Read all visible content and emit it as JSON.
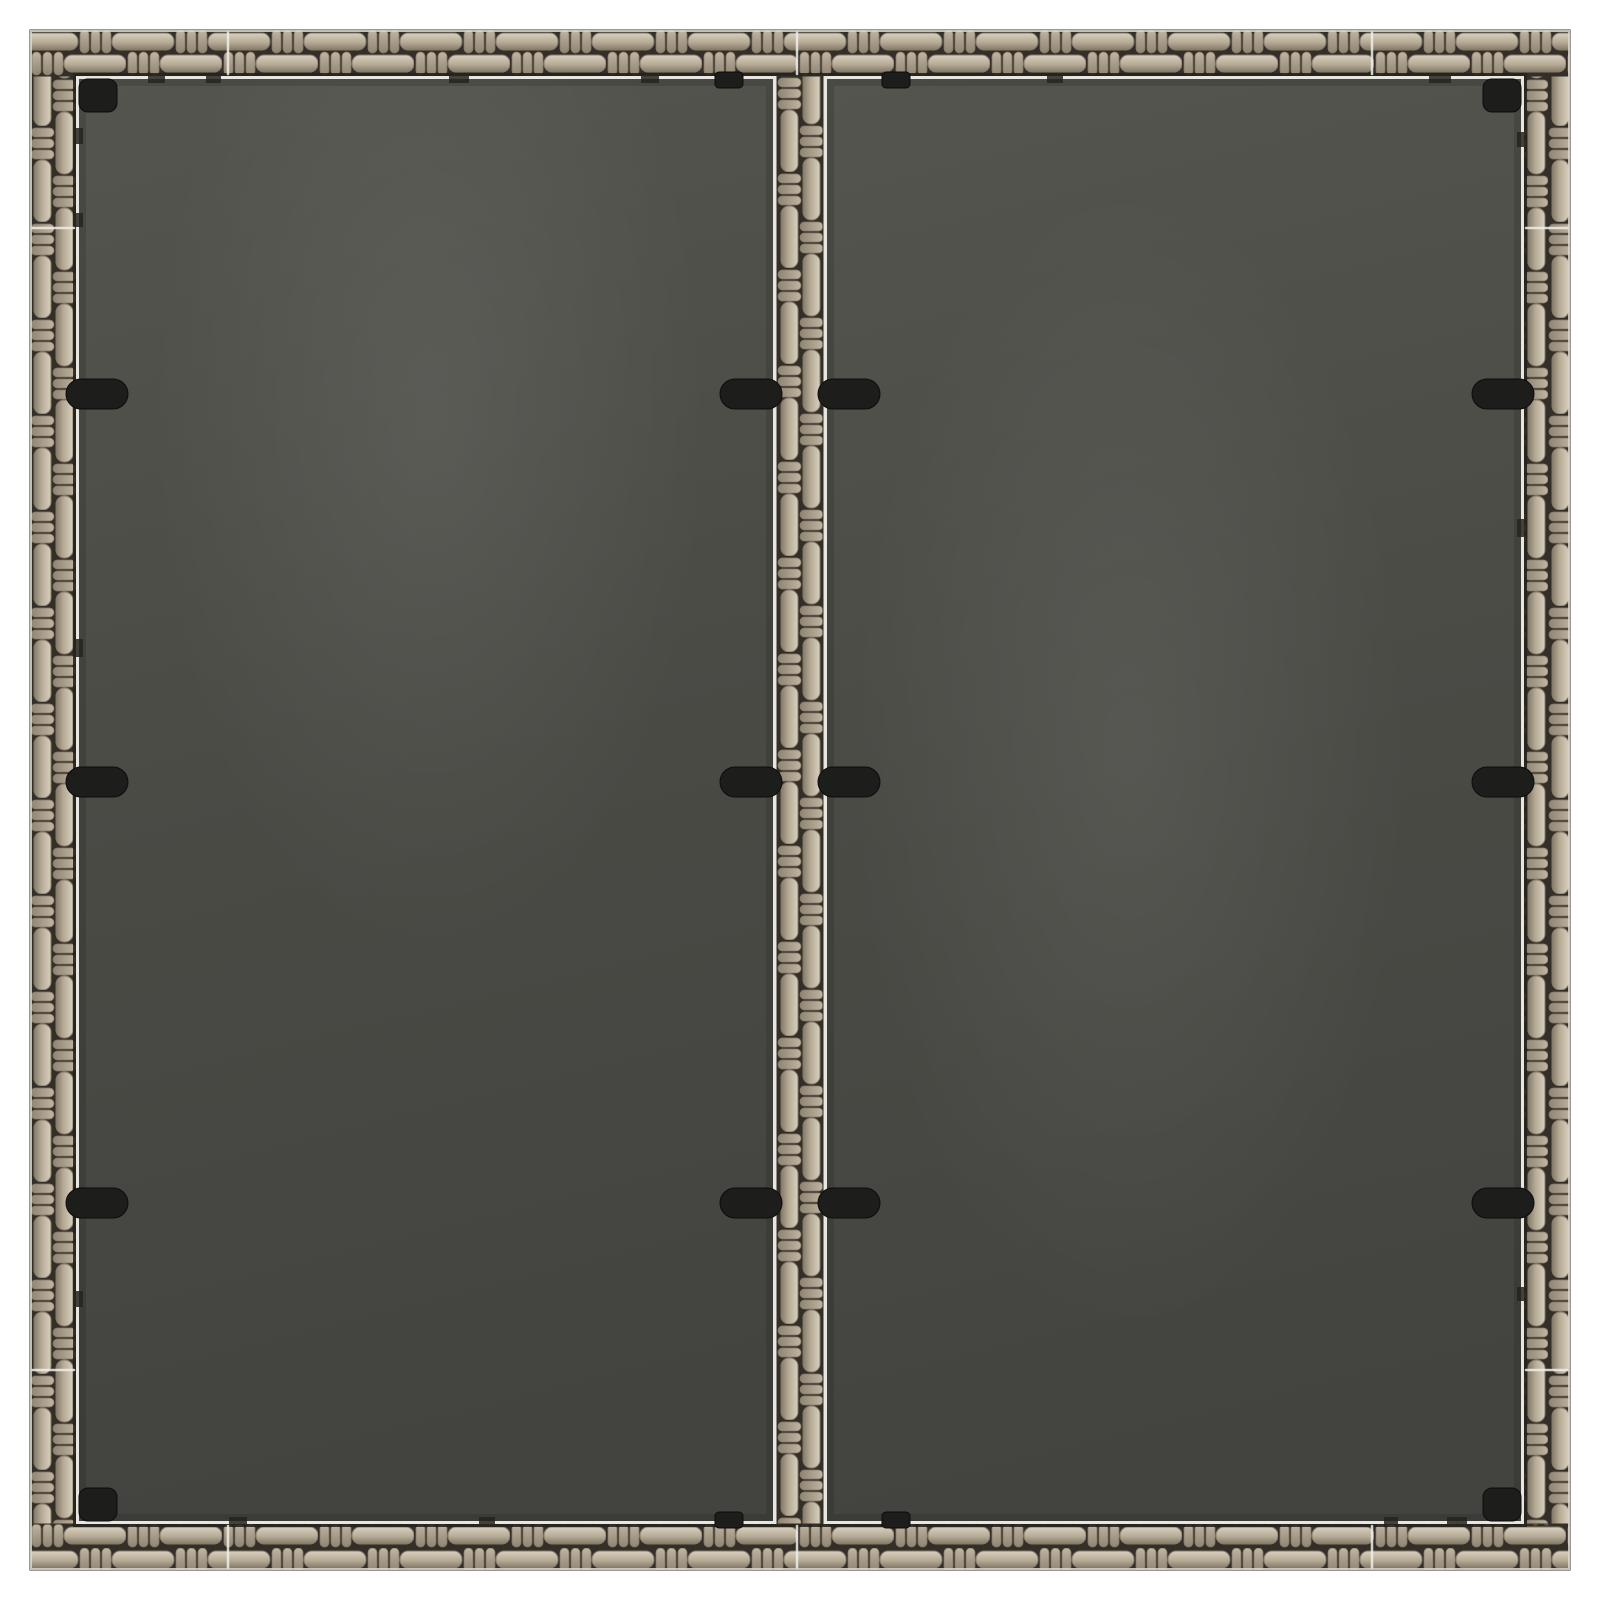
{
  "image": {
    "kind": "product-photo",
    "description": "Top-down view of a square grey poly rattan garden table top on a white background: woven rattan frame, two smoked tempered-glass panels separated by a woven centre divider strip, held by black glass clips, corner brackets and edge tabs.",
    "background_color": "#ffffff"
  },
  "table": {
    "parts": {
      "frame": "woven poly rattan frame",
      "divider": "woven centre divider strip",
      "glass_left": "left smoked glass panel",
      "glass_right": "right smoked glass panel",
      "hardware": "black glass clips, corner brackets and edge tabs"
    },
    "hardware_counts": {
      "edge_clips": 6,
      "divider_clips": 6,
      "corner_brackets": 4,
      "edge_tabs": 4
    },
    "colors": {
      "background": "#ffffff",
      "rattan_light": "#d8cfbe",
      "rattan_mid": "#b6ab97",
      "rattan_dark": "#847a67",
      "rattan_nub": "#c0b5a1",
      "rattan_nub_dark": "#8f8473",
      "weave_shadow": "#332e27",
      "glass_top": "#54554e",
      "glass_mid": "#4a4a45",
      "glass_bottom": "#434340",
      "edge_light": "#e8e6e1",
      "edge_dark": "#26231d",
      "seam_light": "#f0eee9",
      "hardware_black": "#1d1d1c",
      "outer_highlight": "#dcd8d0"
    }
  }
}
